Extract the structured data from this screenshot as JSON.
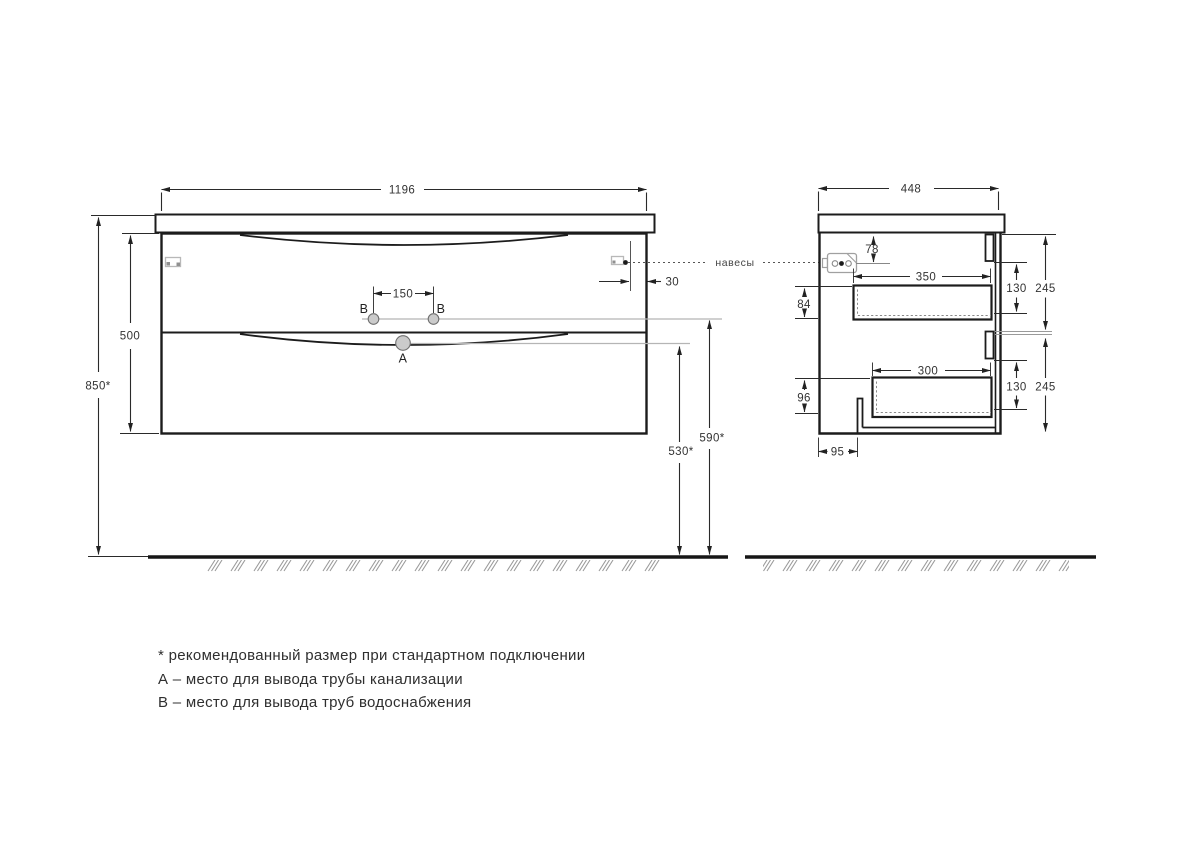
{
  "front_view": {
    "width": "1196",
    "overall_height": "850*",
    "body_height": "500",
    "water_holes_spacing": "150",
    "hanger_offset": "30",
    "drain_outlet_height": "530*",
    "water_outlet_height": "590*",
    "hole_a": "A",
    "hole_b_left": "B",
    "hole_b_right": "B"
  },
  "side_view": {
    "depth": "448",
    "hanger_drop": "78",
    "upper_drawer_back_height": "84",
    "upper_drawer_depth": "350",
    "upper_drawer_front_height": "130",
    "upper_section_height": "245",
    "lower_drawer_depth": "300",
    "lower_drawer_back_height": "96",
    "lower_drawer_front_height": "130",
    "lower_section_height": "245",
    "bottom_recess_depth": "95"
  },
  "callouts": {
    "hangers": "навесы"
  },
  "notes": {
    "asterisk": "* рекомендованный размер при стандартном подключении",
    "a": "А – место для вывода трубы канализации",
    "b": "В – место для вывода труб водоснабжения"
  },
  "colors": {
    "line": "#1c1c1c",
    "dim_line": "#2a2a2a",
    "dim_text": "#333333",
    "gray_guide": "#b5b5b5",
    "hatch": "#9a9a9a",
    "hole_fill": "#cbcbcb"
  }
}
